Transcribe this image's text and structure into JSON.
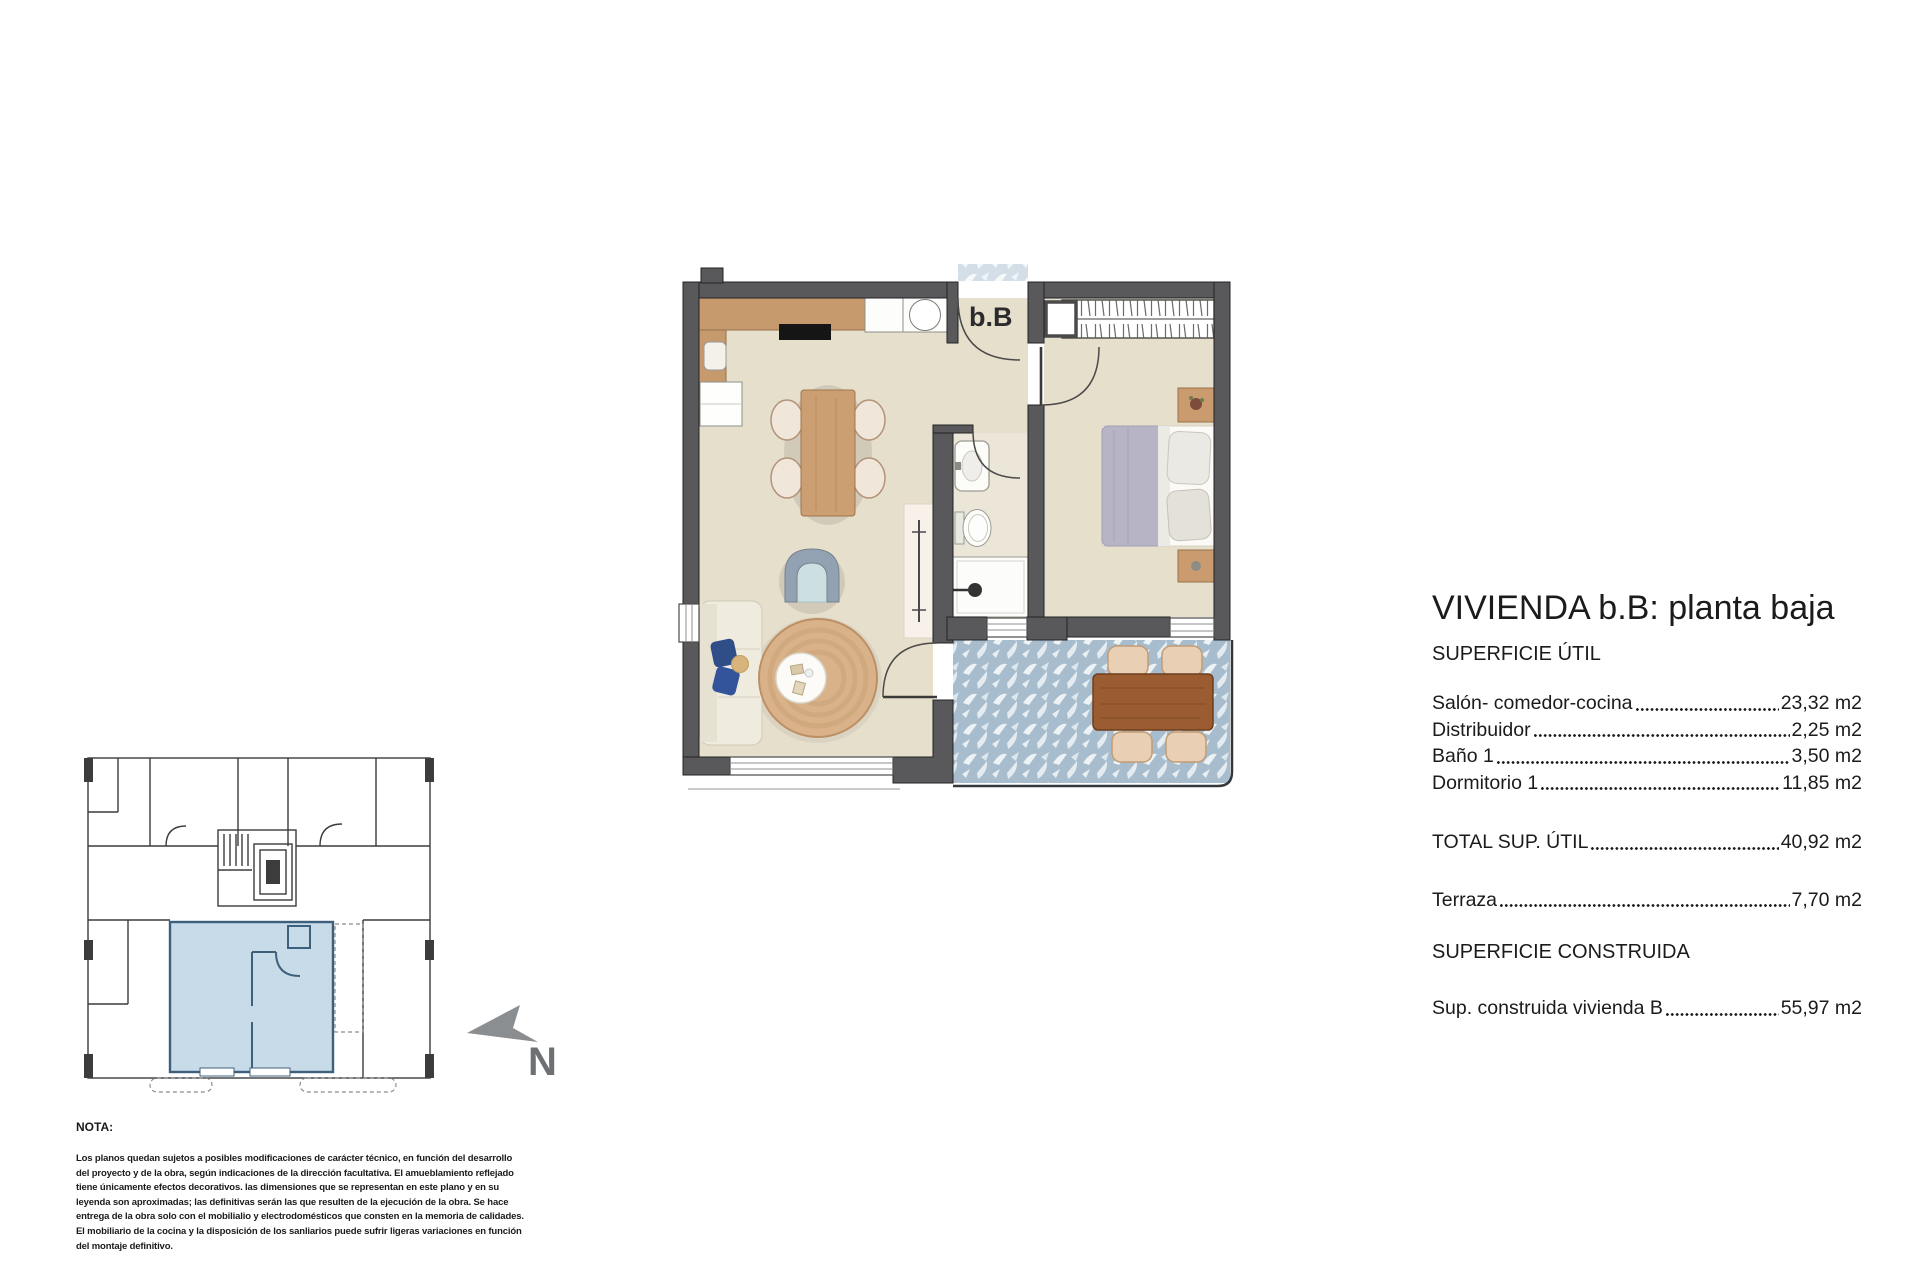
{
  "plan": {
    "unit_label": "b.B"
  },
  "key_plan": {
    "north_label": "N"
  },
  "details": {
    "title": "VIVIENDA b.B: planta baja",
    "superficie_util_heading": "SUPERFICIE ÚTIL",
    "rows": [
      {
        "label": "Salón- comedor-cocina",
        "value": "23,32 m2"
      },
      {
        "label": "Distribuidor",
        "value": "2,25 m2"
      },
      {
        "label": "Baño 1",
        "value": "3,50 m2"
      },
      {
        "label": "Dormitorio 1",
        "value": "11,85 m2"
      }
    ],
    "total": {
      "label": "TOTAL SUP. ÚTIL",
      "value": "40,92 m2"
    },
    "terraza": {
      "label": "Terraza",
      "value": "7,70 m2"
    },
    "superficie_construida_heading": "SUPERFICIE CONSTRUIDA",
    "construida": {
      "label": "Sup. construida vivienda B",
      "value": "55,97 m2"
    }
  },
  "note": {
    "heading": "NOTA:",
    "lines": [
      "Los planos quedan sujetos a posibles modificaciones de carácter técnico, en función del desarrollo",
      "del proyecto y de la obra, según indicaciones de la dirección facultativa. El amueblamiento reflejado",
      "tiene únicamente efectos decorativos. las dimensiones que se representan en este plano y en su",
      "leyenda son aproximadas; las definitivas serán las que resulten de la ejecución de la obra. Se hace",
      "entrega de la obra solo con el mobilialio y electrodomésticos que consten en la memoria de calidades.",
      "El mobiliario de la cocina y la disposición de los sanliarios puede sufrir ligeras variaciones en función",
      "del montaje definitivo."
    ]
  },
  "colors": {
    "wall": "#59595b",
    "floor": "#e6dfcc",
    "wood": "#c69a6c",
    "terrace_tile": "#a7bccd",
    "unit_highlight": "#c8dbe9",
    "unit_outline": "#3f607c",
    "text": "#1b1b1b"
  }
}
